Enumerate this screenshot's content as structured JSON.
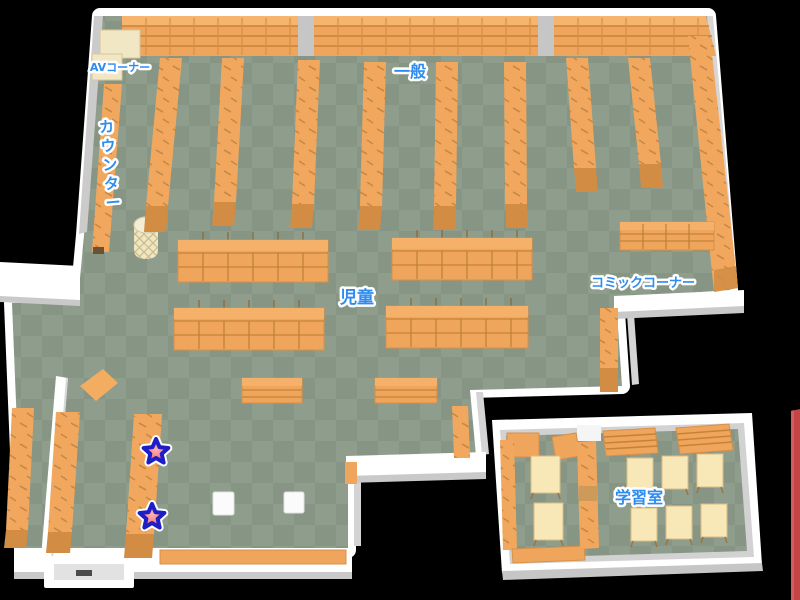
{
  "map": {
    "type": "library-floor-map",
    "areas": {
      "av_corner": "AVコーナー",
      "general": "一般",
      "counter": "カウンター",
      "children": "児童",
      "comic_corner": "コミックコーナー",
      "study_room": "学習室"
    },
    "markers": {
      "shape": "star",
      "count": 2
    },
    "colors": {
      "background": "#000000",
      "floor_light": "#8F9E8C",
      "floor_dark": "#869584",
      "shelf_orange": "#F1A85E",
      "shelf_dark": "#D28C44",
      "wall_white": "#FFFFFF",
      "wall_gray": "#CBCBCB",
      "label_blue": "#2E8CF0",
      "star_fill": "#F25C5C",
      "star_outline": "#1E1EC8",
      "cream": "#F1E7C5",
      "table_cream": "#F8E8B8",
      "neighbor_red": "#C34545"
    }
  }
}
